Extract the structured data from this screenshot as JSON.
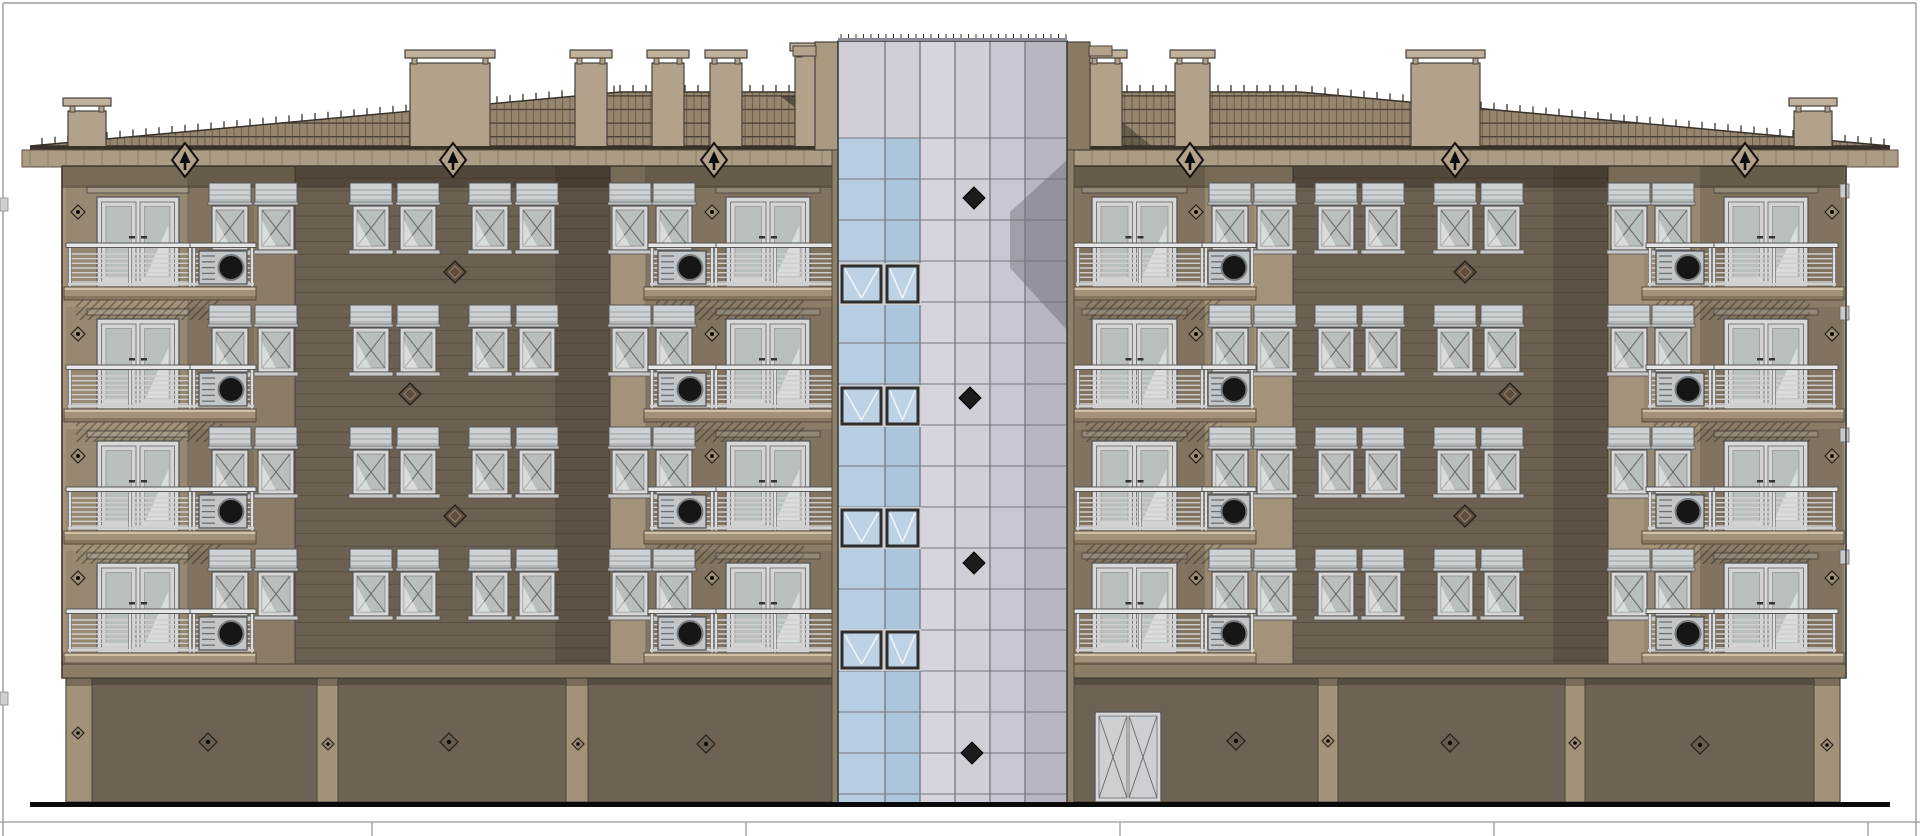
{
  "palette": {
    "bg": "#ffffff",
    "sheet_border": "#9b9b9b",
    "tile": "#97866f",
    "tile_v": "#6a5c4c",
    "tile_h": "#4b4238",
    "roof_line": "#38322a",
    "fascia": "#ab9c85",
    "fascia_tick": "#8d7e68",
    "fascia_edge": "#5c5243",
    "chimney": "#b2a28b",
    "chimney_cap": "#c0b19b",
    "outline": "#46403a",
    "wall": "#a3937a",
    "wall_inset": "rgba(0,0,0,0.07)",
    "shade": "rgba(32,24,14,0.18)",
    "siding": "#6b6051",
    "siding_line": "#59503f",
    "under_eave": "rgba(28,21,12,0.32)",
    "slab_top": "#cfc0a6",
    "slab": "#a3927a",
    "slab_low": "#87775f",
    "slab_edge": "#574d3f",
    "rail": "#e6e6e6",
    "rail_mid": "#cfcfcf",
    "rail_stroke": "#4c4c4c",
    "frame": "#d8d8d8",
    "frame_stroke": "#565656",
    "glass": "#b9bfbc",
    "sash": "#6f6f6f",
    "glass_hi": "rgba(255,255,255,0.45)",
    "box": "#ced1d4",
    "box_line": "#9ba1a5",
    "ac": "#c3c6c8",
    "ac_fan": "#161616",
    "garage": "#6d6253",
    "garage_pilaster": "#a29278",
    "cornice": "#8c7d67",
    "blue1": "#b7cde1",
    "blue2": "#adc5db",
    "lav1": "#d8d4de",
    "lav2": "#d2ced8",
    "lav3": "#cbc7d2",
    "lav4": "#b9b5c1",
    "grid": "#76767e",
    "pair_frame": "#2e2e2e",
    "pair_glass": "#bdd2e4",
    "pair_line": "#eef3f8",
    "tower_line": "#3c3c42",
    "tower_shadow": "rgba(72,72,80,0.32)",
    "orn_dark": "#0d0b09",
    "orn_fill": "#b2a28b",
    "diamond_dark": "#1c1c1c",
    "flank_light": "#a8997f",
    "flank_dark": "#8a7a62",
    "strip": "#8f8068",
    "ground": "#0a0a0a",
    "hatch": "rgba(0,0,0,0.30)"
  },
  "sheet": {
    "w": 1920,
    "h": 836,
    "border": {
      "top_y": 3,
      "left_x": 3,
      "right_x": 1916
    },
    "edge_tabs_y": [
      198,
      692
    ],
    "table": {
      "y": 822,
      "dividers_x": [
        372,
        746,
        1120,
        1494,
        1868
      ]
    },
    "ground": {
      "x0": 30,
      "x1": 1890,
      "y": 802,
      "h": 5
    }
  },
  "roof": {
    "eave_y": 146,
    "top_y": 92,
    "top_x0": 620,
    "top_x1": 1300,
    "x0": 30,
    "x1": 1890,
    "fascia_y": 150,
    "fascia_h": 17,
    "fascia_x0": 22,
    "fascia_x1": 1898,
    "tick_step": 18,
    "tile_w": 7.3,
    "tile_h": 13.6,
    "shadow_left": [
      [
        780,
        96
      ],
      [
        838,
        96
      ],
      [
        838,
        140
      ]
    ],
    "shadow_right": [
      [
        1090,
        96
      ],
      [
        1152,
        146
      ],
      [
        1090,
        146
      ]
    ],
    "ornaments_x": [
      185,
      453,
      714,
      1190,
      1455,
      1745
    ],
    "ornament_y": 160
  },
  "chimneys": [
    [
      68,
      38,
      98
    ],
    [
      410,
      80,
      50
    ],
    [
      575,
      32,
      50
    ],
    [
      652,
      32,
      50
    ],
    [
      710,
      32,
      50
    ],
    [
      795,
      32,
      43
    ],
    [
      1090,
      32,
      50
    ],
    [
      1175,
      35,
      50
    ],
    [
      1411,
      69,
      50
    ],
    [
      1794,
      38,
      98
    ]
  ],
  "walls": {
    "x0": 62,
    "x1": 1846,
    "top": 166,
    "bottom": 678,
    "side_tabs": {
      "right_x": 1840,
      "w": 9,
      "y0": 184,
      "h": 14
    }
  },
  "floors": {
    "count": 4,
    "pitch": 122,
    "box_y": 183,
    "box_h": 22,
    "glass_y": 206,
    "glass_h": 44,
    "win_w": 36,
    "door_y": 197,
    "door_h": 90,
    "rail_y": 245,
    "slab_y": 287,
    "slab_h": 13,
    "diamond_y": 212
  },
  "bays": [
    {
      "door_x": 97,
      "door_w": 82,
      "diamond_x": 78,
      "slab": [
        64,
        256
      ],
      "rail": [
        68,
        192
      ],
      "ac": [
        192,
        254
      ],
      "win_x": [
        212,
        258
      ],
      "shade": [
        187,
        295
      ]
    },
    {
      "door_x": 726,
      "door_w": 84,
      "diamond_x": 712,
      "slab": [
        644,
        838
      ],
      "rail": [
        714,
        836
      ],
      "ac": [
        650,
        714
      ],
      "win_x": [
        612,
        656
      ],
      "shade": [
        645,
        838
      ]
    },
    {
      "door_x": 1092,
      "door_w": 85,
      "diamond_x": 1196,
      "slab": [
        1074,
        1256
      ],
      "rail": [
        1076,
        1204
      ],
      "ac": [
        1204,
        1254
      ],
      "win_x": [
        1212,
        1257
      ],
      "shade": [
        1074,
        1205
      ]
    },
    {
      "door_x": 1724,
      "door_w": 84,
      "diamond_x": 1832,
      "slab": [
        1642,
        1844
      ],
      "rail": [
        1712,
        1836
      ],
      "ac": [
        1648,
        1712
      ],
      "win_x": [
        1611,
        1655
      ],
      "shade": [
        1700,
        1844
      ]
    }
  ],
  "dark_sections": [
    {
      "x0": 295,
      "x1": 610,
      "win_x": [
        353,
        400,
        472,
        519
      ],
      "diamonds": [
        [
          455,
          272
        ],
        [
          410,
          394
        ],
        [
          455,
          516
        ]
      ]
    },
    {
      "x0": 1293,
      "x1": 1608,
      "win_x": [
        1318,
        1365,
        1437,
        1484
      ],
      "diamonds": [
        [
          1465,
          272
        ],
        [
          1510,
          394
        ],
        [
          1465,
          516
        ]
      ]
    }
  ],
  "tower": {
    "x0": 838,
    "x1": 1067,
    "top": 38,
    "glass_top": 41,
    "bottom": 806,
    "cols": [
      838,
      885,
      920,
      955,
      990,
      1025,
      1067
    ],
    "row_y0": 138,
    "row_h": 41,
    "blue_col_count": 2,
    "flank": {
      "left": [
        815,
        838
      ],
      "right": [
        1067,
        1090
      ],
      "cap_l": [
        793,
        816
      ],
      "cap_r": [
        1089,
        1112
      ],
      "cap_y": 46,
      "cap_h": 10,
      "flank_y": 42,
      "flank_h": 108,
      "strip_y": 150
    },
    "pairs_y": [
      266,
      388,
      510,
      632
    ],
    "pair_h": 36,
    "diamonds": [
      [
        974,
        198
      ],
      [
        970,
        398
      ],
      [
        974,
        563
      ],
      [
        972,
        753
      ]
    ],
    "shadow_poly": [
      [
        1067,
        160
      ],
      [
        1067,
        330
      ],
      [
        1010,
        268
      ],
      [
        1010,
        212
      ]
    ]
  },
  "garage": {
    "x0": 66,
    "x1": 1840,
    "top": 678,
    "bottom": 802,
    "cornice_y": 664,
    "cornice_h": 14,
    "pilasters": [
      [
        66,
        92
      ],
      [
        317,
        338
      ],
      [
        566,
        588
      ],
      [
        1318,
        1338
      ],
      [
        1565,
        1585
      ],
      [
        1814,
        1840
      ]
    ],
    "door": {
      "x": 1095,
      "w": 66,
      "y": 712,
      "h": 90
    },
    "panel_diamonds": [
      [
        208,
        742
      ],
      [
        449,
        742
      ],
      [
        706,
        744
      ],
      [
        1236,
        741
      ],
      [
        1450,
        743
      ],
      [
        1700,
        745
      ]
    ],
    "pilaster_diamonds": [
      [
        78,
        733
      ],
      [
        328,
        744
      ],
      [
        578,
        744
      ],
      [
        1328,
        741
      ],
      [
        1575,
        743
      ],
      [
        1827,
        745
      ]
    ]
  }
}
